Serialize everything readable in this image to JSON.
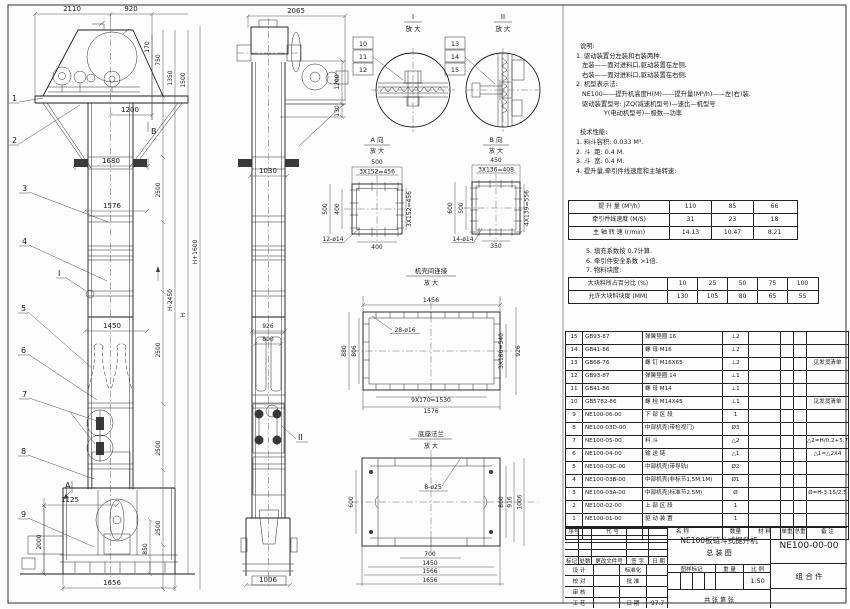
{
  "drawing": {
    "product_title": "NE100板链斗式提升机",
    "drawing_title": "总  装  图",
    "drawing_no": "NE100-00-00",
    "assembly": "组  合  件",
    "scale": "1:50",
    "date": "97.7",
    "sheet_note": "共   张  第   张"
  },
  "front_view": {
    "balloons": [
      "1",
      "2",
      "3",
      "4",
      "5",
      "6",
      "7",
      "8",
      "9"
    ],
    "view_a": "A",
    "view_b": "B",
    "section_i": "I",
    "dims": {
      "top_left": "2110",
      "top_right": "920",
      "head_offset": "1200",
      "w_bracket": "1680",
      "w_flange": "1576",
      "w_mid": "1450",
      "v_170": "170",
      "v_750": "750",
      "v_1350": "1350",
      "v_1500": "1500",
      "seg_2500": "2500",
      "h_plus": "H+1600",
      "h_minus": "H-2450",
      "h": "H",
      "b_1125": "1125",
      "b_2000": "2000",
      "b_850": "850",
      "b_1656": "1656"
    }
  },
  "side_view": {
    "section_ii": "II",
    "dims": {
      "top": "2065",
      "w_1030": "1030",
      "w_926": "926",
      "w_800": "800",
      "w_1006": "1006",
      "v_1200": "1200",
      "v_130": "130"
    }
  },
  "detail_i": {
    "num": "I",
    "sub": "放 大",
    "balloons": [
      "10",
      "11",
      "12"
    ]
  },
  "detail_ii": {
    "num": "II",
    "sub": "放 大",
    "balloons": [
      "13",
      "14",
      "15"
    ]
  },
  "detail_a": {
    "title": "A 向",
    "sub": "放 大",
    "dims": {
      "t1": "500",
      "t2": "3X152=456",
      "l1": "500",
      "l2": "400",
      "r1": "3X152=456",
      "b1": "400",
      "holes": "12-ø14"
    }
  },
  "detail_b": {
    "title": "B 向",
    "sub": "放 大",
    "dims": {
      "t1": "450",
      "t2": "3X136=408",
      "l1": "600",
      "l2": "500",
      "r1": "4X139=556",
      "b1": "350",
      "holes": "14-ø14"
    }
  },
  "detail_joint": {
    "title": "机壳间连接",
    "sub": "放 大",
    "dims": {
      "t1": "1456",
      "l1": "880",
      "l2": "806",
      "r1": "3X180=540",
      "r2": "926",
      "b1": "9X170=1530",
      "b2": "1576",
      "holes": "28-ø16"
    }
  },
  "detail_base": {
    "title": "底座法兰",
    "sub": "放 大",
    "dims": {
      "l1": "600",
      "r1": "800",
      "r2": "916",
      "r3": "1006",
      "b1": "700",
      "b2": "1450",
      "b3": "1566",
      "b4": "1656",
      "holes": "8-ø25"
    }
  },
  "notes": {
    "lines": [
      "  说明:",
      "1. 驱动装置分左装和右装两种.",
      "   左装——面对进料口,驱动装置在左侧.",
      "   右装——面对进料口,驱动装置在右侧.",
      "2. 机型表示法:",
      "   NE100——提升机高度H(M)——提升量(M³/h)——左(右)装.",
      "   驱动装置型号: JZQ(减速机型号)—速比—机型号",
      "              Y(电动机型号)—极数—功率",
      "",
      "  技术性能:",
      "1. 料斗容积: 0.033 M³.",
      "2. 斗  距: 0.4 M.",
      "3. 斗  宽: 0.4 M.",
      "4. 提升量,牵引件线速度和主轴转速:"
    ],
    "post_lines": [
      "5. 填充系数按 0.7计算.",
      "6. 牵引件安全系数 >1倍.",
      "7. 物料块度:"
    ]
  },
  "chart_data": {
    "type": "table",
    "tables": [
      {
        "title": "提升量/牵引件线速度/主轴转速",
        "rows": [
          {
            "label": "提 升 量  (M³/h)",
            "values": [
              "110",
              "85",
              "66"
            ]
          },
          {
            "label": "牵引件线速度 (M/S)",
            "values": [
              "31",
              "23",
              "18"
            ]
          },
          {
            "label": "主 轴 转 速 (r/min)",
            "values": [
              "14.13",
              "10.47",
              "8.21"
            ]
          }
        ]
      },
      {
        "title": "物料块度",
        "rows": [
          {
            "label": "大块料所占百分比 (%)",
            "values": [
              "10",
              "25",
              "50",
              "75",
              "100"
            ]
          },
          {
            "label": "允许大块料块度 (MM)",
            "values": [
              "130",
              "105",
              "80",
              "65",
              "55"
            ]
          }
        ]
      }
    ]
  },
  "bom": {
    "headers": [
      "序号",
      "代  号",
      "名  称",
      "数量",
      "材  料",
      "单重",
      "总重",
      "备  注"
    ],
    "rows": [
      {
        "no": "15",
        "code": "GB93-87",
        "name": "弹簧垫圈  16",
        "qty": "⊥2",
        "material": "",
        "unit_w": "",
        "total_w": "",
        "remark": ""
      },
      {
        "no": "14",
        "code": "GB41-86",
        "name": "螺  母  M16",
        "qty": "⊥2",
        "material": "",
        "unit_w": "",
        "total_w": "",
        "remark": ""
      },
      {
        "no": "13",
        "code": "GB68-76",
        "name": "螺  钉  M16X65",
        "qty": "⊥2",
        "material": "",
        "unit_w": "",
        "total_w": "",
        "remark": "见发货清单"
      },
      {
        "no": "12",
        "code": "GB93-87",
        "name": "弹簧垫圈  14",
        "qty": "⊥1",
        "material": "",
        "unit_w": "",
        "total_w": "",
        "remark": ""
      },
      {
        "no": "11",
        "code": "GB41-86",
        "name": "螺  母  M14",
        "qty": "⊥1",
        "material": "",
        "unit_w": "",
        "total_w": "",
        "remark": ""
      },
      {
        "no": "10",
        "code": "GB5782-86",
        "name": "螺  栓  M14X45",
        "qty": "⊥1",
        "material": "",
        "unit_w": "",
        "total_w": "",
        "remark": "见发货清单"
      },
      {
        "no": "9",
        "code": "NE100-06-00",
        "name": "下 部 区 段",
        "qty": "1",
        "material": "",
        "unit_w": "",
        "total_w": "",
        "remark": ""
      },
      {
        "no": "8",
        "code": "NE100-03D-00",
        "name": "中部机壳(带检视门)",
        "qty": "Ø3",
        "material": "",
        "unit_w": "",
        "total_w": "",
        "remark": ""
      },
      {
        "no": "7",
        "code": "NE100-05-00",
        "name": "料  斗",
        "qty": "△2",
        "material": "",
        "unit_w": "",
        "total_w": "",
        "remark": "△2=H/0.2+5.75"
      },
      {
        "no": "6",
        "code": "NE100-04-00",
        "name": "输 送 链",
        "qty": "△1",
        "material": "",
        "unit_w": "",
        "total_w": "",
        "remark": "△1=△2X4"
      },
      {
        "no": "5",
        "code": "NE100-03C-00",
        "name": "中部机壳(带导轨)",
        "qty": "Ø2",
        "material": "",
        "unit_w": "",
        "total_w": "",
        "remark": ""
      },
      {
        "no": "4",
        "code": "NE100-03B-00",
        "name": "中部机壳(非标节1.5M,1M)",
        "qty": "Ø1",
        "material": "",
        "unit_w": "",
        "total_w": "",
        "remark": ""
      },
      {
        "no": "3",
        "code": "NE100-03A-00",
        "name": "中部机壳(标准节2.5M)",
        "qty": "Ø",
        "material": "",
        "unit_w": "",
        "total_w": "",
        "remark": "Ø=H-3.15/2.5"
      },
      {
        "no": "2",
        "code": "NE100-02-00",
        "name": "上 部 区 段",
        "qty": "1",
        "material": "",
        "unit_w": "",
        "total_w": "",
        "remark": ""
      },
      {
        "no": "1",
        "code": "NE100-01-00",
        "name": "驱 动 装 置",
        "qty": "1",
        "material": "",
        "unit_w": "",
        "total_w": "",
        "remark": ""
      }
    ]
  },
  "title_block": {
    "rev_headers": [
      "标记",
      "处数",
      "更改文件号",
      "签 字",
      "日 期"
    ],
    "roles": [
      "设 计",
      "校 对",
      "审 核",
      "工 艺"
    ],
    "mid_labels": [
      "标准化",
      "批 准",
      "日 期"
    ],
    "stamp_headers": [
      "图样标记",
      "重 量",
      "比 例"
    ]
  }
}
